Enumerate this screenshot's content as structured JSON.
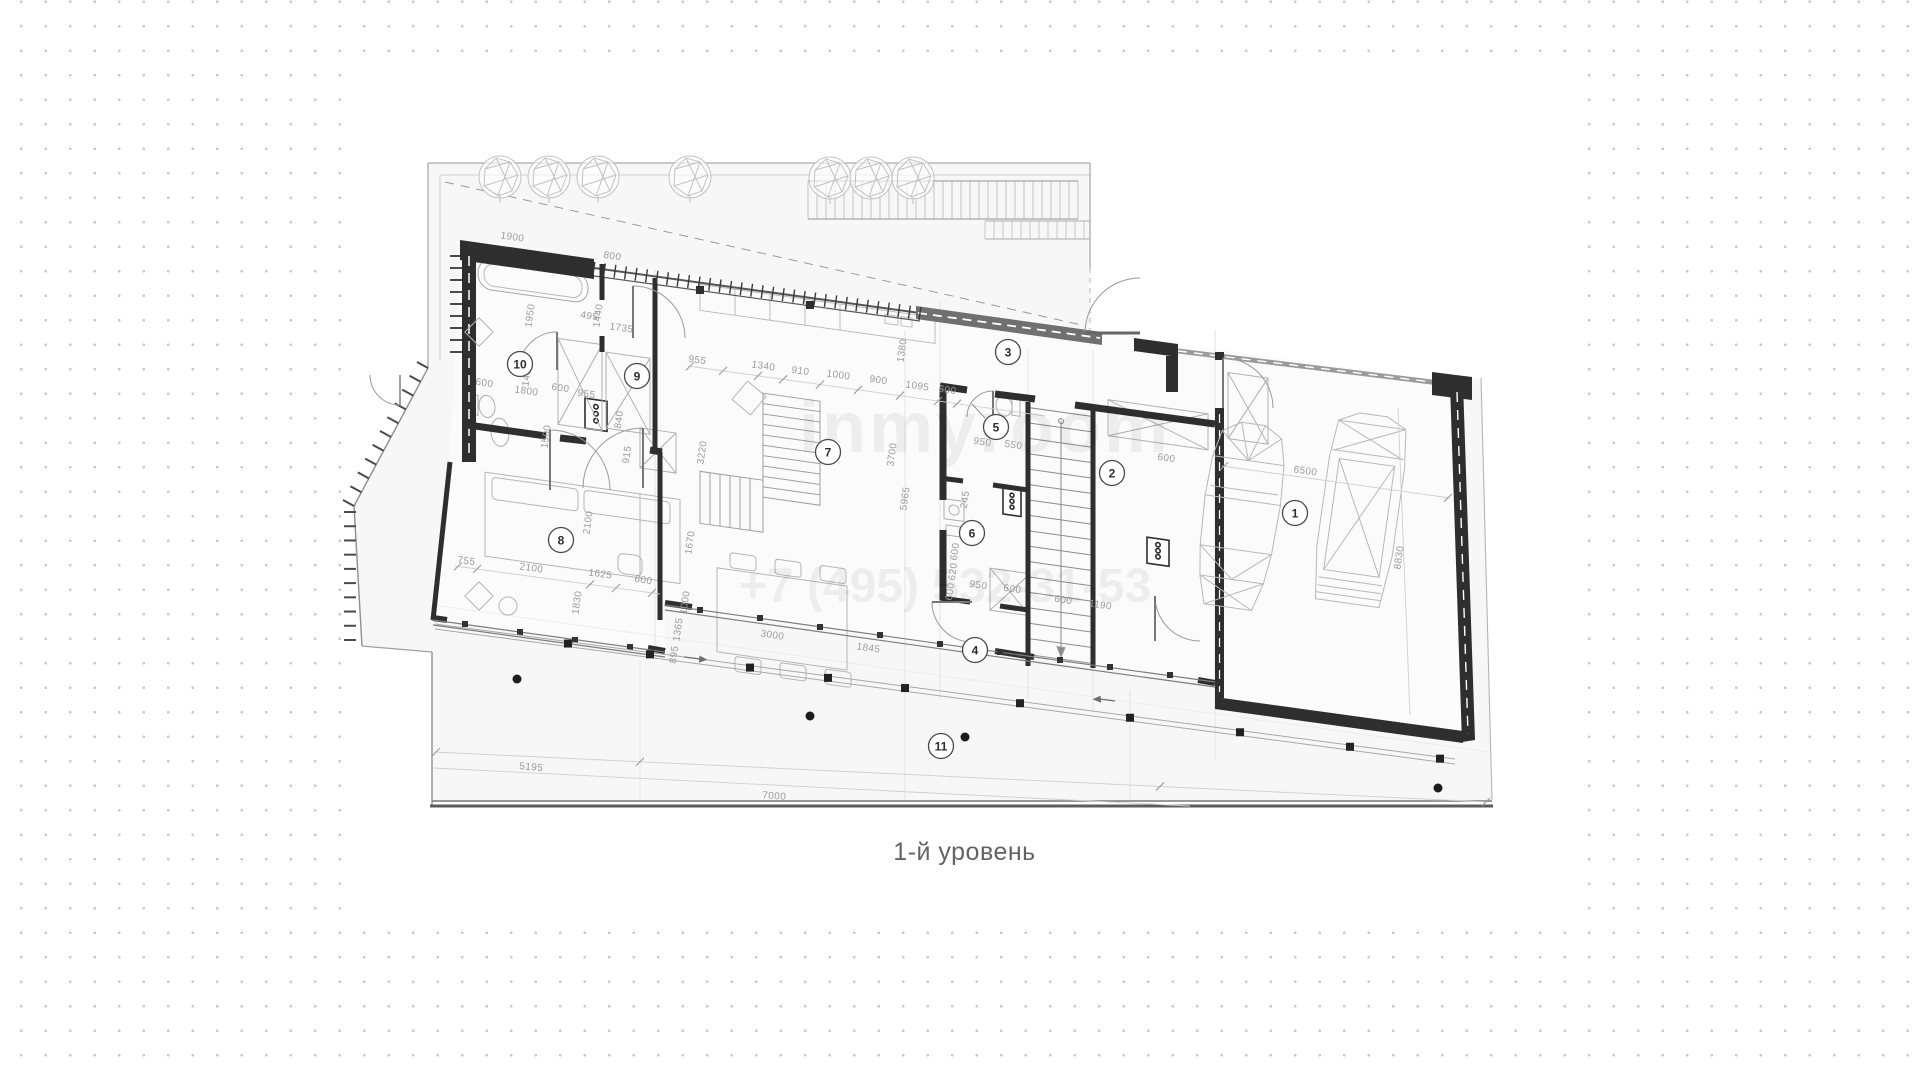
{
  "caption": "1-й уровень",
  "watermark": {
    "line1": "inmyroom",
    "line2": "+7 (495) 532-31-53"
  },
  "colors": {
    "paper": "#ffffff",
    "wall": "#2e2e2e",
    "dim_text": "#9b9b9b",
    "dots": "#c7c7c7"
  },
  "plan": {
    "rooms": [
      {
        "n": "1",
        "x": 1295,
        "y": 513
      },
      {
        "n": "2",
        "x": 1112,
        "y": 473
      },
      {
        "n": "3",
        "x": 1008,
        "y": 352
      },
      {
        "n": "4",
        "x": 975,
        "y": 650
      },
      {
        "n": "5",
        "x": 996,
        "y": 427
      },
      {
        "n": "6",
        "x": 972,
        "y": 533
      },
      {
        "n": "7",
        "x": 828,
        "y": 452
      },
      {
        "n": "8",
        "x": 561,
        "y": 540
      },
      {
        "n": "9",
        "x": 637,
        "y": 376
      },
      {
        "n": "10",
        "x": 520,
        "y": 364
      },
      {
        "n": "11",
        "x": 941,
        "y": 746
      }
    ],
    "dims": [
      {
        "t": "1900",
        "x": 512,
        "y": 240,
        "r": 8
      },
      {
        "t": "800",
        "x": 612,
        "y": 259,
        "r": 8
      },
      {
        "t": "1950",
        "x": 533,
        "y": 316,
        "r": -82
      },
      {
        "t": "495",
        "x": 589,
        "y": 319,
        "r": 8
      },
      {
        "t": "1440",
        "x": 601,
        "y": 316,
        "r": -82
      },
      {
        "t": "1735",
        "x": 621,
        "y": 331,
        "r": 8
      },
      {
        "t": "1450",
        "x": 530,
        "y": 375,
        "r": -82
      },
      {
        "t": "600",
        "x": 484,
        "y": 386,
        "r": 8
      },
      {
        "t": "1800",
        "x": 526,
        "y": 394,
        "r": 8
      },
      {
        "t": "1500",
        "x": 549,
        "y": 437,
        "r": -82
      },
      {
        "t": "955",
        "x": 697,
        "y": 363,
        "r": 8
      },
      {
        "t": "1340",
        "x": 763,
        "y": 369,
        "r": 8
      },
      {
        "t": "910",
        "x": 800,
        "y": 374,
        "r": 8
      },
      {
        "t": "1000",
        "x": 838,
        "y": 378,
        "r": 8
      },
      {
        "t": "900",
        "x": 878,
        "y": 383,
        "r": 8
      },
      {
        "t": "1095",
        "x": 917,
        "y": 389,
        "r": 8
      },
      {
        "t": "600",
        "x": 947,
        "y": 393,
        "r": 8
      },
      {
        "t": "600",
        "x": 560,
        "y": 391,
        "r": 8
      },
      {
        "t": "955",
        "x": 586,
        "y": 397,
        "r": 8
      },
      {
        "t": "840",
        "x": 622,
        "y": 420,
        "r": -82
      },
      {
        "t": "915",
        "x": 630,
        "y": 455,
        "r": -82
      },
      {
        "t": "3220",
        "x": 705,
        "y": 453,
        "r": -82
      },
      {
        "t": "3700",
        "x": 895,
        "y": 455,
        "r": -82
      },
      {
        "t": "5965",
        "x": 908,
        "y": 499,
        "r": -82
      },
      {
        "t": "1670",
        "x": 693,
        "y": 543,
        "r": -82
      },
      {
        "t": "1000",
        "x": 688,
        "y": 603,
        "r": -82
      },
      {
        "t": "1365",
        "x": 681,
        "y": 630,
        "r": -82
      },
      {
        "t": "895",
        "x": 677,
        "y": 655,
        "r": -82
      },
      {
        "t": "2100",
        "x": 591,
        "y": 523,
        "r": -82
      },
      {
        "t": "755",
        "x": 466,
        "y": 564,
        "r": 8
      },
      {
        "t": "2100",
        "x": 531,
        "y": 571,
        "r": 8
      },
      {
        "t": "1625",
        "x": 600,
        "y": 577,
        "r": 8
      },
      {
        "t": "600",
        "x": 643,
        "y": 583,
        "r": 8
      },
      {
        "t": "1830",
        "x": 580,
        "y": 603,
        "r": -82
      },
      {
        "t": "3000",
        "x": 772,
        "y": 638,
        "r": 8
      },
      {
        "t": "1845",
        "x": 868,
        "y": 651,
        "r": 8
      },
      {
        "t": "1380",
        "x": 905,
        "y": 351,
        "r": -82
      },
      {
        "t": "950",
        "x": 982,
        "y": 445,
        "r": 8
      },
      {
        "t": "550",
        "x": 1013,
        "y": 448,
        "r": 8
      },
      {
        "t": "600",
        "x": 1166,
        "y": 461,
        "r": 8
      },
      {
        "t": "6500",
        "x": 1305,
        "y": 474,
        "r": 8
      },
      {
        "t": "8830",
        "x": 1402,
        "y": 558,
        "r": -82
      },
      {
        "t": "245",
        "x": 968,
        "y": 500,
        "r": -82
      },
      {
        "t": "600",
        "x": 958,
        "y": 552,
        "r": -82
      },
      {
        "t": "620",
        "x": 956,
        "y": 572,
        "r": -82
      },
      {
        "t": "600",
        "x": 953,
        "y": 592,
        "r": -82
      },
      {
        "t": "950",
        "x": 978,
        "y": 588,
        "r": 8
      },
      {
        "t": "600",
        "x": 1012,
        "y": 592,
        "r": 8
      },
      {
        "t": "600",
        "x": 1063,
        "y": 603,
        "r": 8
      },
      {
        "t": "1190",
        "x": 1100,
        "y": 608,
        "r": 8
      },
      {
        "t": "5195",
        "x": 531,
        "y": 770,
        "r": 5
      },
      {
        "t": "7000",
        "x": 774,
        "y": 799,
        "r": 4
      }
    ]
  }
}
